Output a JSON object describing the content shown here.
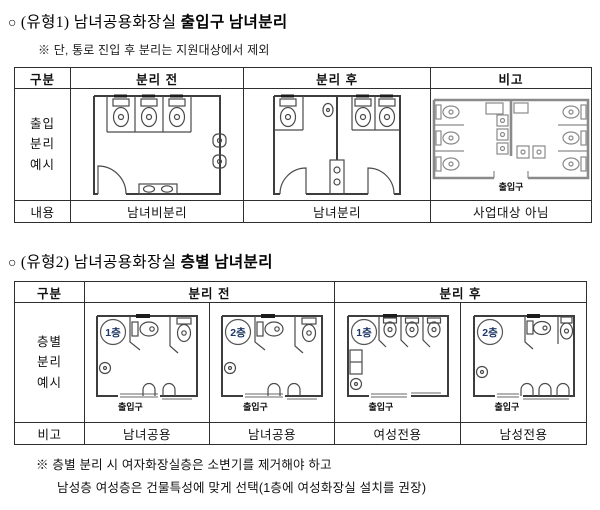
{
  "labels": {
    "entrance": "출입구"
  },
  "colors": {
    "badge_text": "#1F3864",
    "plan_line": "#4a4a4a",
    "corridor_plan_line": "#8a8a8a"
  },
  "section1": {
    "bullet": "○",
    "title_prefix": "(유형1) 남녀공용화장실 ",
    "title_bold": "출입구 남녀분리",
    "note": "※ 단, 통로 진입 후 분리는 지원대상에서 제외",
    "table": {
      "col_headers": [
        "구분",
        "분리 전",
        "분리 후",
        "비고"
      ],
      "row1_label_lines": [
        "출입",
        "분리",
        "예시"
      ],
      "row2": {
        "label": "내용",
        "before": "남녀비분리",
        "after": "남녀분리",
        "note": "사업대상 아님"
      }
    }
  },
  "section2": {
    "bullet": "○",
    "title_prefix": "(유형2) 남녀공용화장실 ",
    "title_bold": "층별 남녀분리",
    "table": {
      "col_headers": [
        "구분",
        "분리 전",
        "분리 후"
      ],
      "row1_label_lines": [
        "층별",
        "분리",
        "예시"
      ],
      "floors": [
        "1층",
        "2층",
        "1층",
        "2층"
      ],
      "row2": {
        "label": "비고",
        "values": [
          "남녀공용",
          "남녀공용",
          "여성전용",
          "남성전용"
        ]
      }
    }
  },
  "footnote": {
    "line1": "※ 층별 분리 시 여자화장실층은 소변기를 제거해야 하고",
    "line2": "남성층 여성층은 건물특성에 맞게 선택(1층에 여성화장실 설치를 권장)"
  }
}
